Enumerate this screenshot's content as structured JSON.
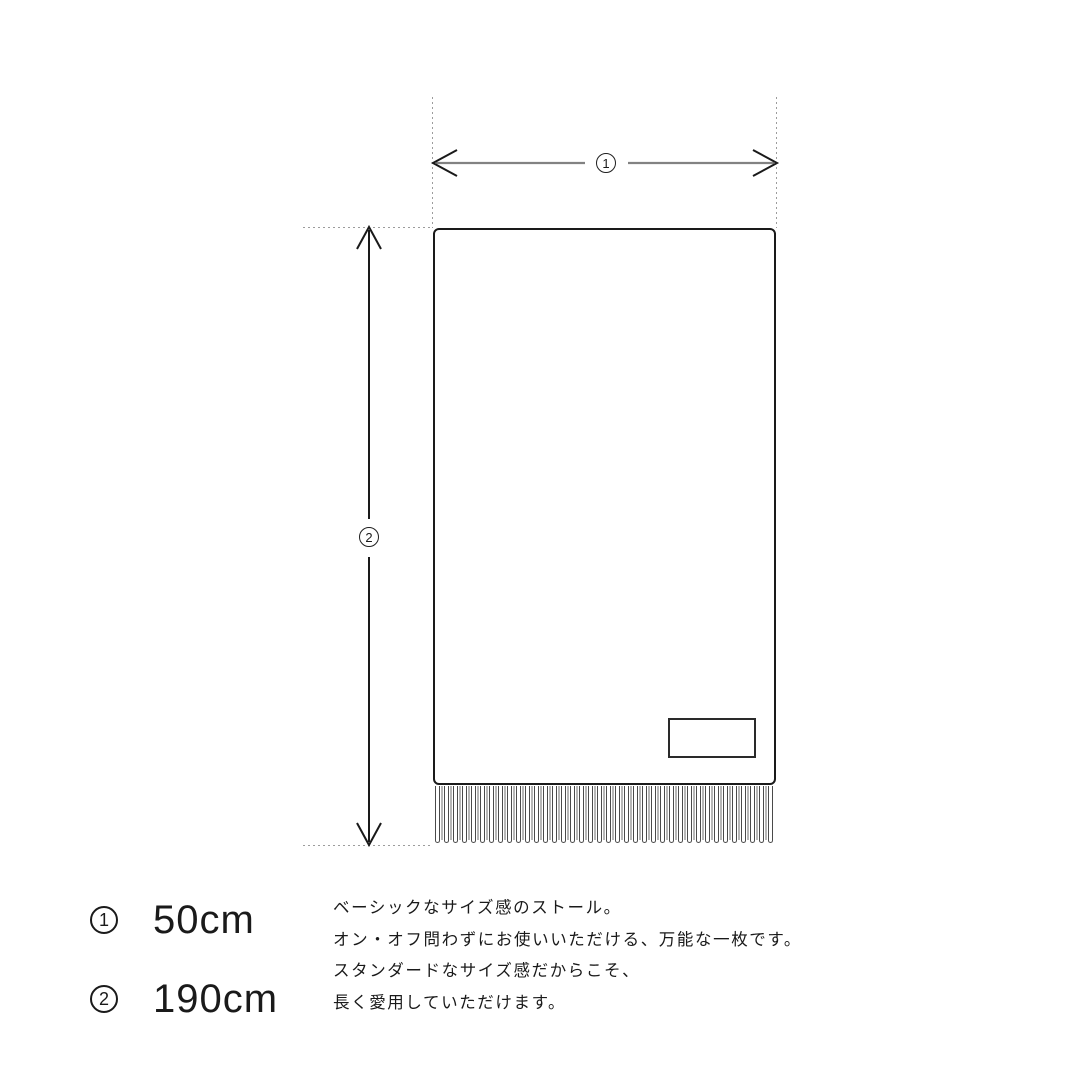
{
  "diagram": {
    "width_label": {
      "symbol": "1"
    },
    "height_label": {
      "symbol": "2"
    },
    "fringe_count": 38
  },
  "legend": {
    "items": [
      {
        "symbol": "1",
        "value": "50cm"
      },
      {
        "symbol": "2",
        "value": "190cm"
      }
    ]
  },
  "description": {
    "lines": [
      "ベーシックなサイズ感のストール。",
      "オン・オフ問わずにお使いいただける、万能な一枚です。",
      "スタンダードなサイズ感だからこそ、",
      "長く愛用していただけます。"
    ]
  },
  "colors": {
    "outline": "#1a1a1a",
    "measure_line_gray": "#828282",
    "guide_dotted": "#9c9c9c",
    "fringe_gray": "#b6b6b6"
  }
}
